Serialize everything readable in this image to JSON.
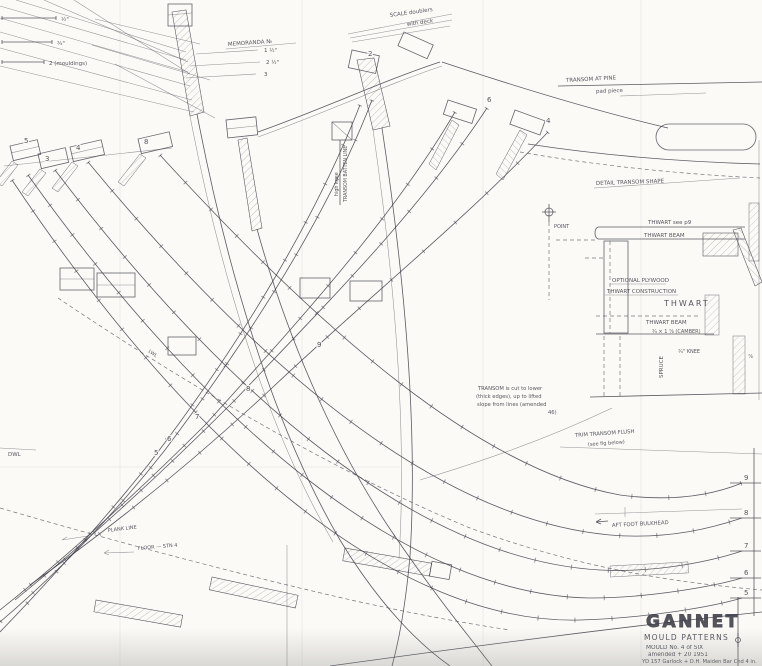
{
  "notes": {
    "tl1": "½\"",
    "tl2": "¾\"",
    "tl3": "2 (mouldings)",
    "memo_heading": "MEMORANDA  №",
    "memo1": "1 ½\"",
    "memo2": "2 ½\"",
    "memo3": "3",
    "scale1": "SCALE  doublers",
    "scale2": "with deck",
    "pine1": "TRANSOM  AT PINE",
    "pine2": "pad piece",
    "vert1": "TRANSOM  BATTEN  LINE",
    "vert2": "high  knee",
    "detail_shape": "DETAIL  TRANSOM  SHAPE",
    "thwart_see": "THWART  see  p9",
    "thwart_beam_top": "THWART  BEAM",
    "opt1": "OPTIONAL  PLYWOOD",
    "opt2": "THWART  CONSTRUCTION",
    "thwart_big": "THWART",
    "beam1": "THWART  BEAM",
    "beam2": "¾ × 1 ⅞  (CAMBER)",
    "spruce": "SPRUCE",
    "knee": "¾\" KNEE",
    "frac78": "⅞",
    "point": "POINT",
    "cut1": "TRANSOM is cut to lower",
    "cut2": "(thick edges), up to lifted",
    "cut3": "slope from lines (amended",
    "cut4": "46)",
    "trim1": "TRIM  TRANSOM  FLUSH",
    "trim2": "(see  fig  below)",
    "aft_bulkhead": "AFT  FOOT  BULKHEAD",
    "plank": "PLANK  LINE",
    "floor": "FLOOR — STN 4",
    "dwl": "DWL",
    "lwl": "LWL"
  },
  "curve_labels": {
    "c9": "9",
    "c8": "8",
    "c7": "7",
    "c6": "6",
    "c5": "5"
  },
  "edge_labels": {
    "e9": "9",
    "e8": "8",
    "e7": "7",
    "e6": "6",
    "e5": "5"
  },
  "head_labels": {
    "h5": "5",
    "h3": "3",
    "h4": "4",
    "h8": "8",
    "h2": "2",
    "h6": "6",
    "h4b": "4"
  },
  "title_block": {
    "title": "GANNET",
    "subtitle": "MOULD  PATTERNS",
    "line3": "MOULD  No. 4  of  SIX",
    "line4": "amended  +  20  1951",
    "line5": "YD 157  Garlock  +  D.H.  Maiden  Bar  Chd  4 in."
  }
}
